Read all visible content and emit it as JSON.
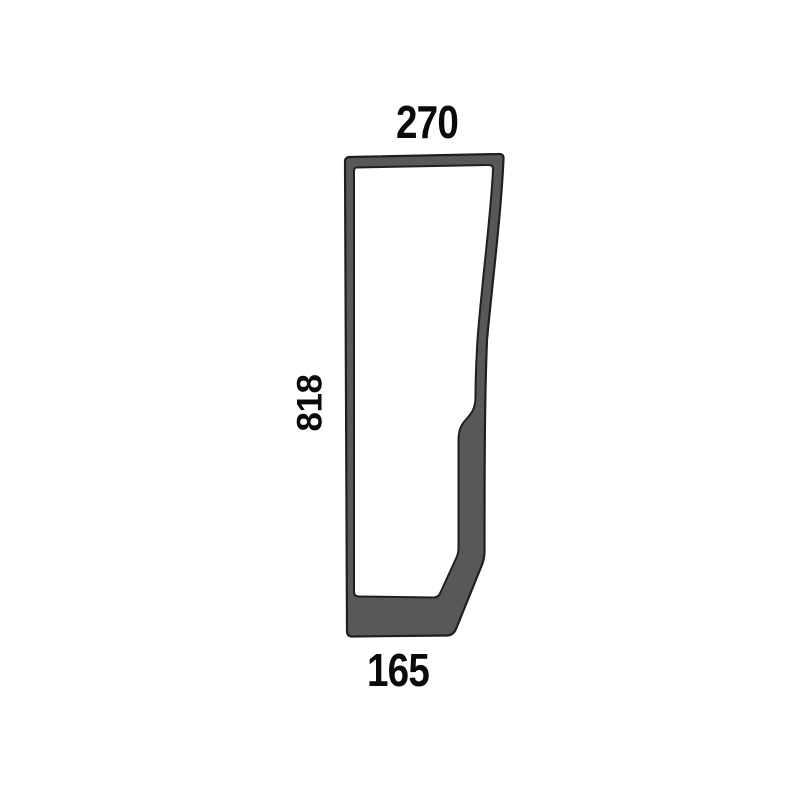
{
  "diagram": {
    "labels": {
      "top": "270",
      "left": "818",
      "bottom": "165"
    },
    "colors": {
      "seal_fill": "#58585a",
      "outline": "#1f1f1f",
      "glass_fill": "#ffffff",
      "text": "#0a0a0a",
      "background": "#ffffff"
    }
  }
}
